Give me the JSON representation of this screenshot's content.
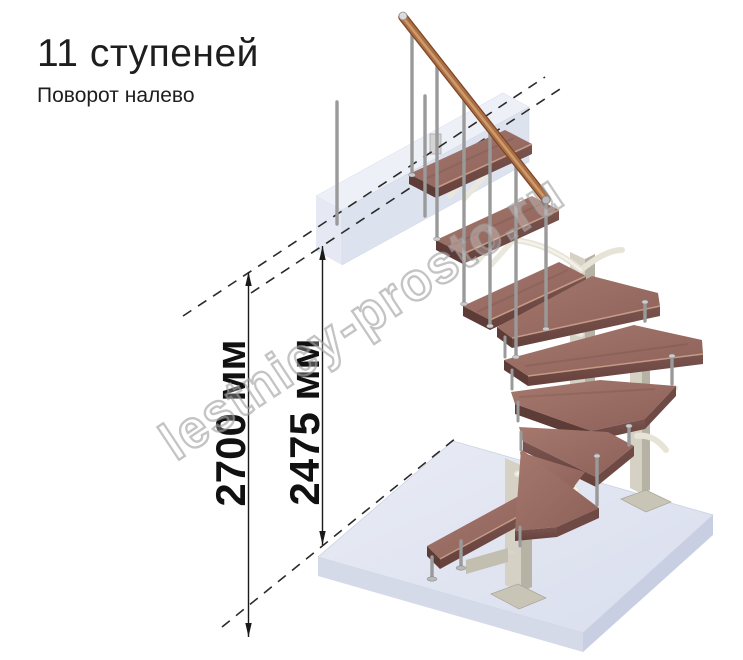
{
  "header": {
    "title": "11 ступеней",
    "subtitle": "Поворот налево"
  },
  "dimensions": {
    "floor_to_floor": "2700 мм",
    "floor_to_top_step": "2475 мм"
  },
  "watermark": "lestnicy-prosto.ru",
  "colors": {
    "background": "#ffffff",
    "title_text": "#1e1e1e",
    "dimension_line": "#1a1a1a",
    "datum_dashed_line": "#2b2b2b",
    "wood_tread_top": "#9d7168",
    "wood_tread_front": "#6f4a44",
    "wood_nosing_highlight": "#c59a87",
    "handrail_copper": "#a96f45",
    "handrail_highlight": "#cf9a6b",
    "post_beige_light": "#d5d1c5",
    "post_beige_dark": "#b6b2a4",
    "branch_support": "#e7e4d7",
    "baluster_gray": "#9a9a9a",
    "floor_slab_top": "#e4e8f2",
    "floor_slab_front": "#d0d5e6",
    "landing_beam": "#dde2ef",
    "watermark_gray": "#9f9f9f"
  }
}
